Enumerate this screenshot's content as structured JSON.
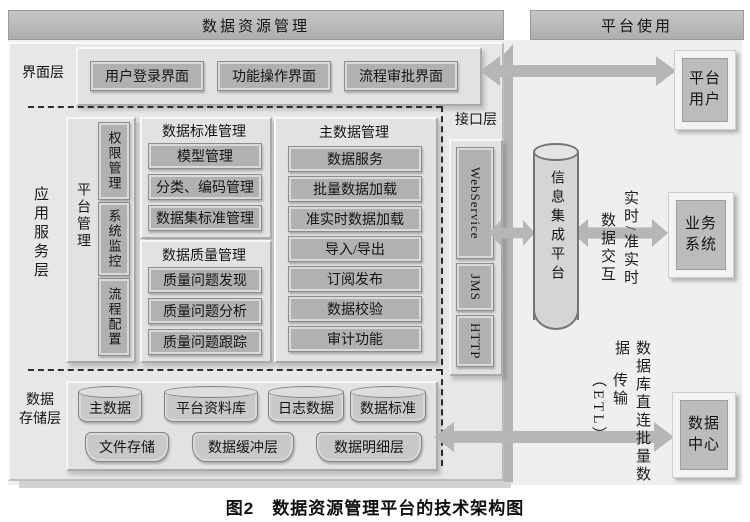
{
  "headers": {
    "left": "数据资源管理",
    "right": "平台使用"
  },
  "interface_layer": {
    "label": "界面层",
    "items": [
      "用户登录界面",
      "功能操作界面",
      "流程审批界面"
    ]
  },
  "app_service_layer": {
    "label": "应用服务层",
    "platform_mgmt": {
      "label": "平台管理",
      "items": [
        "权限管理",
        "系统监控",
        "流程配置"
      ]
    },
    "standards": {
      "title": "数据标准管理",
      "items": [
        "模型管理",
        "分类、编码管理",
        "数据集标准管理"
      ]
    },
    "quality": {
      "title": "数据质量管理",
      "items": [
        "质量问题发现",
        "质量问题分析",
        "质量问题跟踪"
      ]
    },
    "master_data": {
      "title": "主数据管理",
      "items": [
        "数据服务",
        "批量数据加载",
        "准实时数据加载",
        "导入/导出",
        "订阅发布",
        "数据校验",
        "审计功能"
      ]
    }
  },
  "api_layer": {
    "label": "接口层",
    "items": [
      "WebService",
      "JMS",
      "HTTP"
    ]
  },
  "storage_layer": {
    "label": "数据\n存储层",
    "row1": [
      "主数据",
      "平台资料库",
      "日志数据",
      "数据标准"
    ],
    "row2": [
      "文件存储",
      "数据缓冲层",
      "数据明细层"
    ]
  },
  "integration": {
    "cylinder_label": "信息集成平台"
  },
  "external": {
    "platform_user": "平台\n用户",
    "business_system": "业务\n系统",
    "data_center": "数据\n中心"
  },
  "arrow_labels": {
    "mid_col_left": "数据交互",
    "mid_col_right": "实时/准实时",
    "bottom_col_left": "传输（ETL）",
    "bottom_col_right": "数据库直连批量数据"
  },
  "caption": "图2　数据资源管理平台的技术架构图",
  "colors": {
    "arrow": "#b6b6b6",
    "header_bar": "#b5b5b5",
    "panel_background": "#e7e7e7",
    "box_fill": "#b1b1b1",
    "canvas_background": "#efefef",
    "text": "#1a1a1a"
  }
}
